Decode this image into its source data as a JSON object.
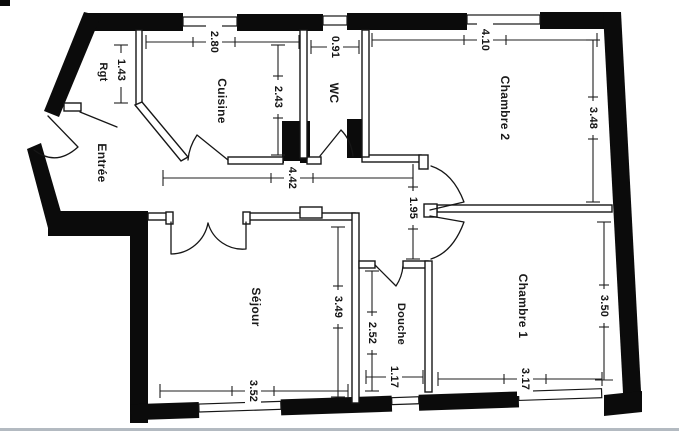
{
  "rooms": {
    "entree": {
      "label": "Entrée"
    },
    "rgt": {
      "label": "Rgt"
    },
    "cuisine": {
      "label": "Cuisine"
    },
    "wc": {
      "label": "WC"
    },
    "chambre2": {
      "label": "Chambre 2"
    },
    "sejour": {
      "label": "Séjour"
    },
    "douche": {
      "label": "Douche"
    },
    "chambre1": {
      "label": "Chambre 1"
    }
  },
  "dims": {
    "d143": "1.43",
    "d280": "2.80",
    "d243": "2.43",
    "d091": "0.91",
    "d410": "4.10",
    "d348": "3.48",
    "d442": "4.42",
    "d195": "1.95",
    "d349": "3.49",
    "d352": "3.52",
    "d252": "2.52",
    "d117": "1.17",
    "d317": "3.17",
    "d350": "3.50"
  },
  "colors": {
    "wall": "#0b0b0b",
    "line": "#1f1f1f",
    "background": "#ffffff",
    "scan_edge": "#9aa3ac"
  }
}
